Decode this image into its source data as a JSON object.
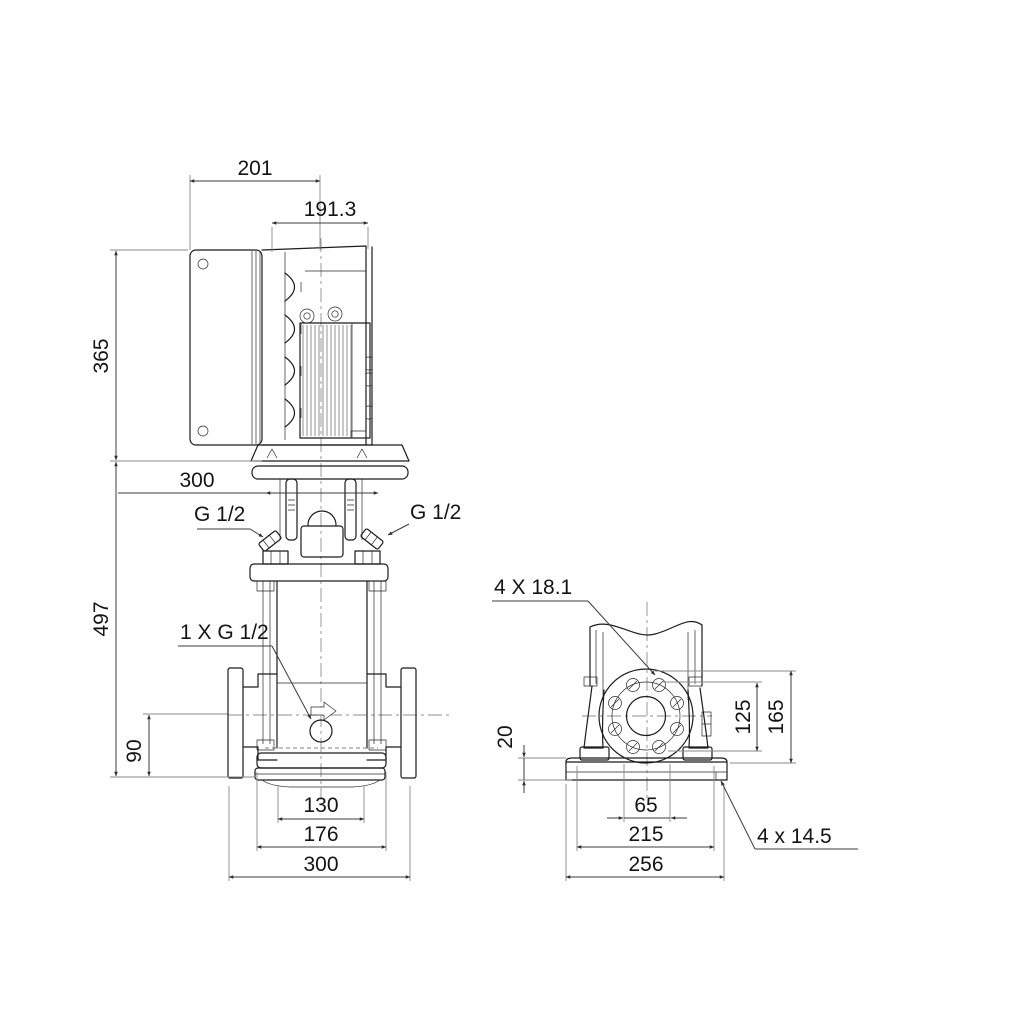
{
  "drawing": {
    "dims": {
      "motor_box_width": "201",
      "motor_depth": "191.3",
      "motor_height": "365",
      "head_width": "300",
      "vent_plug_left": "G 1/2",
      "vent_plug_right": "G 1/2",
      "pump_height": "497",
      "drain_plug": "1 X G 1/2",
      "port_center_height": "90",
      "port_flange_width": "130",
      "foot_ring_width": "176",
      "base_width": "300",
      "flange_holes": "4 X 18.1",
      "flange_hole_span": "125",
      "flange_top_height": "165",
      "base_plate_thickness": "20",
      "base_slot_span": "65",
      "base_hole_spacing": "215",
      "base_depth": "256",
      "base_holes": "4 x 14.5"
    }
  }
}
